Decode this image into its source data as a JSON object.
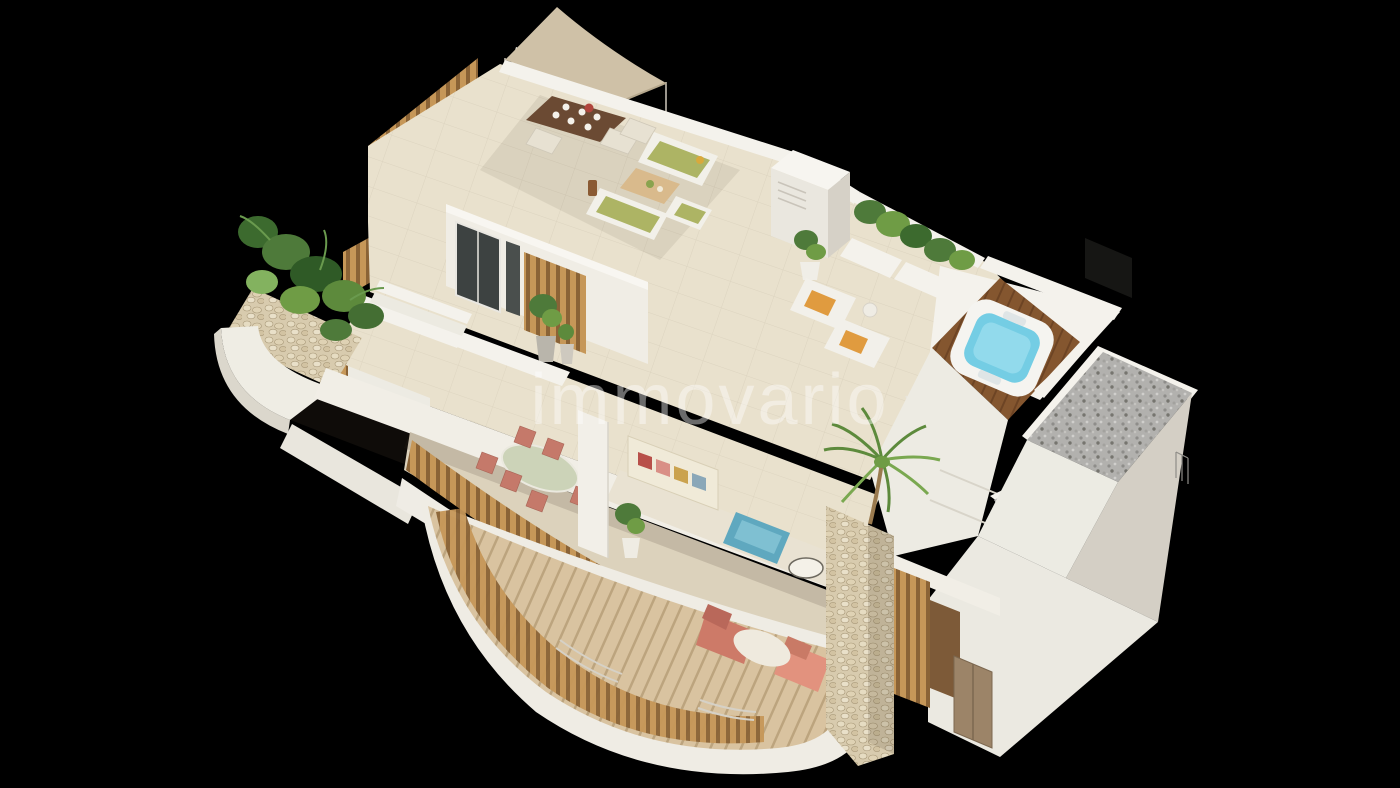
{
  "meta": {
    "width": 1400,
    "height": 788,
    "background": "#000000"
  },
  "watermark": {
    "text": "immovario",
    "color": "#ffffff",
    "opacity": 0.42
  },
  "palette": {
    "bg": "#000000",
    "floor_cream": "#e9e1cd",
    "floor_cream_dark": "#dcd1b9",
    "wall_white": "#f4f2ec",
    "wall_shade": "#d9d4ca",
    "sail_beige": "#cfc1a7",
    "wood_slat": "#c69758",
    "wood_slat_dark": "#8a6336",
    "deck_wood": "#d9c3a0",
    "jacuzzi_wood": "#84562f",
    "water_blue": "#74cde4",
    "gravel": "#b1b0ad",
    "stone": "#d8cbae",
    "plant": "#4e7a3a",
    "plant_light": "#6f9c45",
    "terracotta": "#c5796a",
    "salmon": "#e2927e",
    "olive": "#adb464",
    "sofa_blue": "#5fa8bf",
    "towel_orange": "#e09b3f",
    "table_wood_dark": "#6b4a33",
    "door_brown": "#9c8468"
  }
}
